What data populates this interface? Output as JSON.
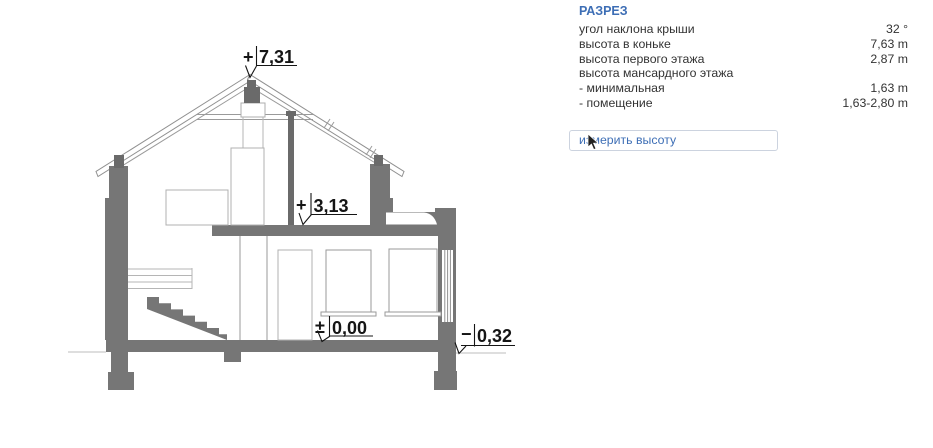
{
  "panel": {
    "title": "РАЗРЕЗ",
    "rows": [
      {
        "label": "угол наклона крыши",
        "value": "32 °"
      },
      {
        "label": "высота в коньке",
        "value": "7,63 m"
      },
      {
        "label": "высота первого этажа",
        "value": "2,87 m"
      },
      {
        "label": "высота мансардного этажа",
        "value": ""
      },
      {
        "label": "- минимальная",
        "value": "1,63 m"
      },
      {
        "label": "- помещение",
        "value": "1,63-2,80 m"
      }
    ],
    "measure_button": "измерить высоту"
  },
  "drawing": {
    "type": "architectural-cross-section",
    "levels": {
      "ridge": {
        "sign": "+",
        "value": "7,31"
      },
      "attic_floor": {
        "sign": "+",
        "value": "3,13"
      },
      "ground_floor": {
        "sign": "±",
        "value": "0,00"
      },
      "terrain": {
        "sign": "−",
        "value": "0,32"
      }
    },
    "colors": {
      "wall_fill": "#767676",
      "dark_fill": "#6a6a6a",
      "outline": "#909090",
      "light_outline": "#b0b0b0",
      "marker_text": "#151515",
      "accent_blue": "#3d6eb5"
    }
  }
}
